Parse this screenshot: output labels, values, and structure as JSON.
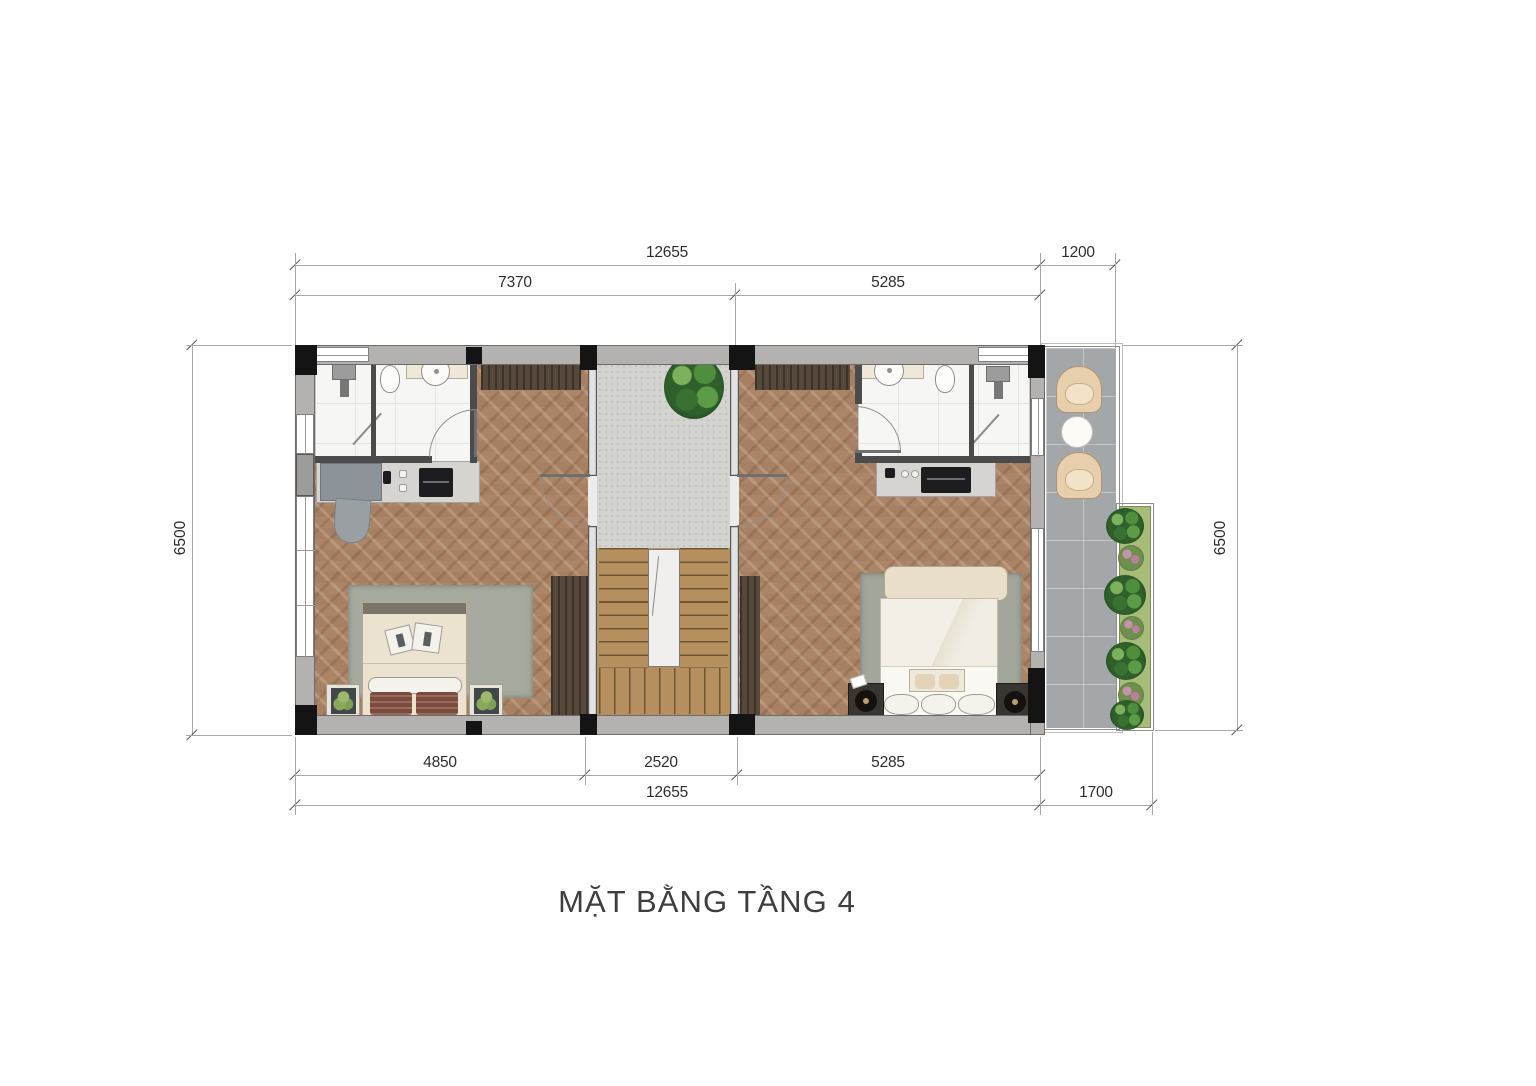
{
  "title": "MẶT BẰNG TẦNG 4",
  "dimensions": {
    "top_outer": [
      "12655",
      "1200"
    ],
    "top_inner": [
      "7370",
      "5285"
    ],
    "bottom_inner": [
      "4850",
      "2520",
      "5285"
    ],
    "bottom_outer": [
      "12655",
      "1700"
    ],
    "left": "6500",
    "right": "6500"
  },
  "palette": {
    "wood_floor": "#ac8568",
    "stair_wood": "#b5905e",
    "landing_carpet": "#d3d4cf",
    "balcony_tile": "#a3a7aa",
    "wall_grey": "#b4b2b0",
    "column_black": "#141414",
    "wardrobe_dark_wood": "#57483c",
    "bed_cream": "#ebe2cf",
    "armchair_beige": "#e7cfae",
    "plant_green": "#2f5f2a",
    "planter_green": "#a8bc79"
  }
}
